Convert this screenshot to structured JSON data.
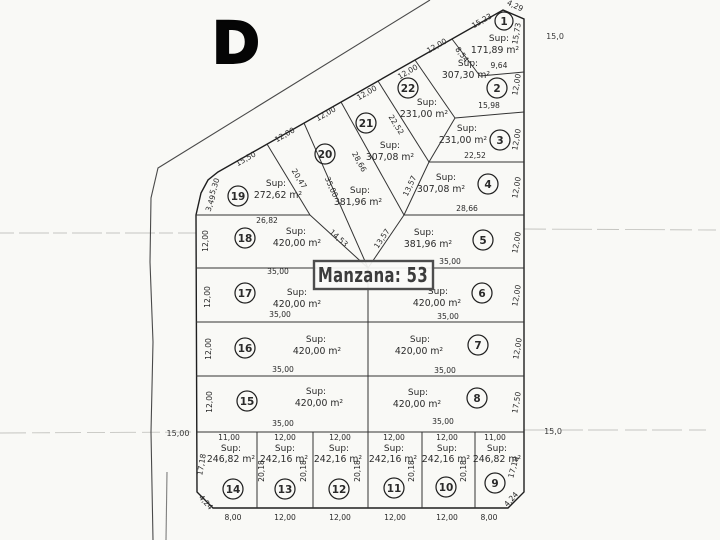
{
  "sheet": {
    "letter": "D"
  },
  "block": {
    "title": "Manzana: 53"
  },
  "labels": {
    "sup": "Sup:"
  },
  "streets": {
    "left_width": "15,00",
    "right_width_top": "15,0",
    "right_width_bottom": "15,0"
  },
  "lots": {
    "1": {
      "num": "1",
      "area": "171,89 m²",
      "dims": {
        "left": "8,54",
        "top": "15,23",
        "corner": "4,29",
        "right": "15,73",
        "bottom": "9,64"
      }
    },
    "2": {
      "num": "2",
      "area": "307,30 m²",
      "dims": {
        "top": "12,00",
        "right": "12,00",
        "bottom": "15,98"
      }
    },
    "3": {
      "num": "3",
      "area": "231,00 m²",
      "dims": {
        "right": "12,00",
        "bottom": "22,52"
      }
    },
    "4": {
      "num": "4",
      "area": "307,08 m²",
      "dims": {
        "left": "13,57",
        "right": "12,00",
        "bottom": "28,66"
      }
    },
    "5": {
      "num": "5",
      "area": "381,96 m²",
      "dims": {
        "left": "13,57",
        "right": "12,00",
        "bottom": "35,00"
      }
    },
    "6": {
      "num": "6",
      "area": "420,00 m²",
      "dims": {
        "right": "12,00",
        "bottom": "35,00"
      }
    },
    "7": {
      "num": "7",
      "area": "420,00 m²",
      "dims": {
        "right": "12,00",
        "bottom": "35,00"
      }
    },
    "8": {
      "num": "8",
      "area": "420,00 m²",
      "dims": {
        "right": "17,50",
        "bottom": "35,00"
      }
    },
    "9": {
      "num": "9",
      "area": "246,82 m²",
      "dims": {
        "top": "11,00",
        "right": "17,18",
        "corner": "4,24",
        "bottom": "8,00"
      }
    },
    "10": {
      "num": "10",
      "area": "242,16 m²",
      "dims": {
        "top": "12,00",
        "side": "20,18",
        "bottom": "12,00"
      }
    },
    "11": {
      "num": "11",
      "area": "242,16 m²",
      "dims": {
        "top": "12,00",
        "side": "20,18",
        "bottom": "12,00"
      }
    },
    "12": {
      "num": "12",
      "area": "242,16 m²",
      "dims": {
        "top": "12,00",
        "side": "20,18",
        "bottom": "12,00"
      }
    },
    "13": {
      "num": "13",
      "area": "242,16 m²",
      "dims": {
        "top": "12,00",
        "side_left": "20,18",
        "side_right": "20,18",
        "bottom": "12,00"
      }
    },
    "14": {
      "num": "14",
      "area": "246,82 m²",
      "dims": {
        "top": "11,00",
        "left": "17,18",
        "corner": "4,24",
        "bottom": "8,00"
      }
    },
    "15": {
      "num": "15",
      "area": "420,00 m²",
      "dims": {
        "left": "12,00",
        "bottom": "35,00"
      }
    },
    "16": {
      "num": "16",
      "area": "420,00 m²",
      "dims": {
        "left": "12,00",
        "bottom": "35,00"
      }
    },
    "17": {
      "num": "17",
      "area": "420,00 m²",
      "dims": {
        "left": "12,00",
        "top": "35,00",
        "bottom": "35,00"
      }
    },
    "18": {
      "num": "18",
      "area": "420,00 m²",
      "dims": {
        "left": "12,00",
        "top": "26,82",
        "right": "14,53"
      }
    },
    "19": {
      "num": "19",
      "area": "272,62 m²",
      "dims": {
        "top": "15,50",
        "left_upper": "5,30",
        "left_lower": "3,49",
        "right": "20,47"
      }
    },
    "20": {
      "num": "20",
      "dims": {
        "top": "12,00"
      }
    },
    "21": {
      "num": "21",
      "area": "307,08 m²",
      "dims": {
        "top": "12,00",
        "right": "22,52"
      }
    },
    "22": {
      "num": "22",
      "area": "231,00 m²",
      "dims": {
        "top": "12,00"
      }
    },
    "center": {
      "area": "381,96 m²",
      "dims": {
        "top": "12,00",
        "left": "35,00",
        "right": "28,66",
        "bottom": "13,57"
      }
    }
  }
}
